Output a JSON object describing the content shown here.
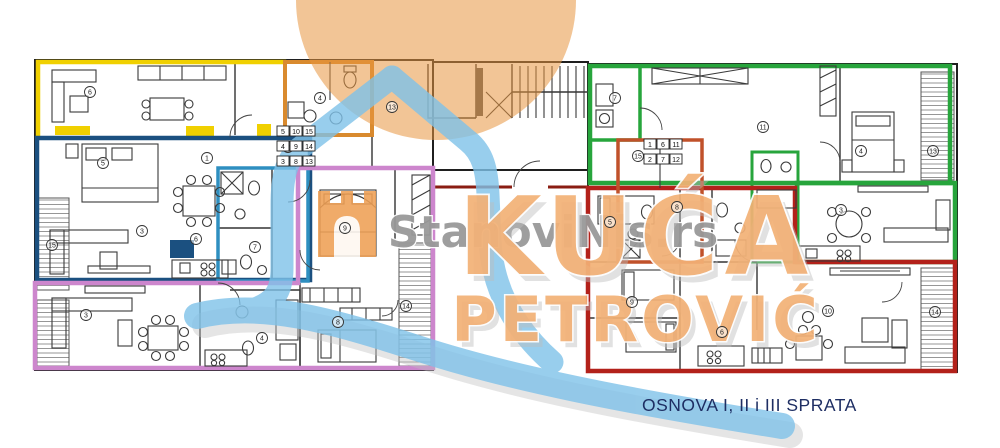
{
  "caption": {
    "text": "OSNOVA I, II i III SPRATA",
    "color": "#1e2e63"
  },
  "watermark": {
    "site_text": "StanoviNis.rs",
    "brand_line1": "KUĆA",
    "brand_line2": "PETROVIĆ",
    "circle_color": "#e8963f",
    "blue_color": "#7fc2e9",
    "shadow_color": "#bdbdbd",
    "letters_color": "#f3b176",
    "site_text_color": "#999999",
    "castle_color": "#efa055"
  },
  "plan": {
    "outline_colors": {
      "yellow": "#f0d000",
      "orange_unit": "#d98a2e",
      "navy": "#1b5080",
      "cyan": "#2e8fc0",
      "pink": "#cd86cd",
      "green": "#27a53c",
      "red": "#b3211a",
      "brick": "#c0512a",
      "corridor_wall": "#8a1d12"
    },
    "unit_label_groups": [
      {
        "x": 277,
        "y": 126,
        "rows": [
          [
            "5",
            "10",
            "15"
          ],
          [
            "4",
            "9",
            "14"
          ],
          [
            "3",
            "8",
            "13"
          ]
        ]
      },
      {
        "x": 644,
        "y": 139,
        "rows": [
          [
            "1",
            "6",
            "11"
          ],
          [
            "2",
            "7",
            "12"
          ]
        ]
      }
    ],
    "room_numbers": [
      {
        "x": 90,
        "y": 92,
        "n": "6"
      },
      {
        "x": 320,
        "y": 98,
        "n": "4"
      },
      {
        "x": 392,
        "y": 107,
        "n": "13"
      },
      {
        "x": 103,
        "y": 163,
        "n": "5"
      },
      {
        "x": 207,
        "y": 158,
        "n": "1"
      },
      {
        "x": 288,
        "y": 147,
        "n": "2"
      },
      {
        "x": 142,
        "y": 231,
        "n": "3"
      },
      {
        "x": 196,
        "y": 239,
        "n": "6"
      },
      {
        "x": 255,
        "y": 247,
        "n": "7"
      },
      {
        "x": 52,
        "y": 245,
        "n": "15"
      },
      {
        "x": 345,
        "y": 228,
        "n": "9"
      },
      {
        "x": 406,
        "y": 306,
        "n": "14"
      },
      {
        "x": 338,
        "y": 322,
        "n": "8"
      },
      {
        "x": 262,
        "y": 338,
        "n": "4"
      },
      {
        "x": 86,
        "y": 315,
        "n": "3"
      },
      {
        "x": 615,
        "y": 98,
        "n": "7"
      },
      {
        "x": 763,
        "y": 127,
        "n": "11"
      },
      {
        "x": 861,
        "y": 151,
        "n": "4"
      },
      {
        "x": 933,
        "y": 151,
        "n": "13"
      },
      {
        "x": 841,
        "y": 210,
        "n": "3"
      },
      {
        "x": 677,
        "y": 207,
        "n": "8"
      },
      {
        "x": 638,
        "y": 156,
        "n": "15"
      },
      {
        "x": 610,
        "y": 222,
        "n": "5"
      },
      {
        "x": 632,
        "y": 302,
        "n": "9"
      },
      {
        "x": 722,
        "y": 332,
        "n": "6"
      },
      {
        "x": 828,
        "y": 311,
        "n": "10"
      },
      {
        "x": 935,
        "y": 312,
        "n": "14"
      }
    ]
  }
}
